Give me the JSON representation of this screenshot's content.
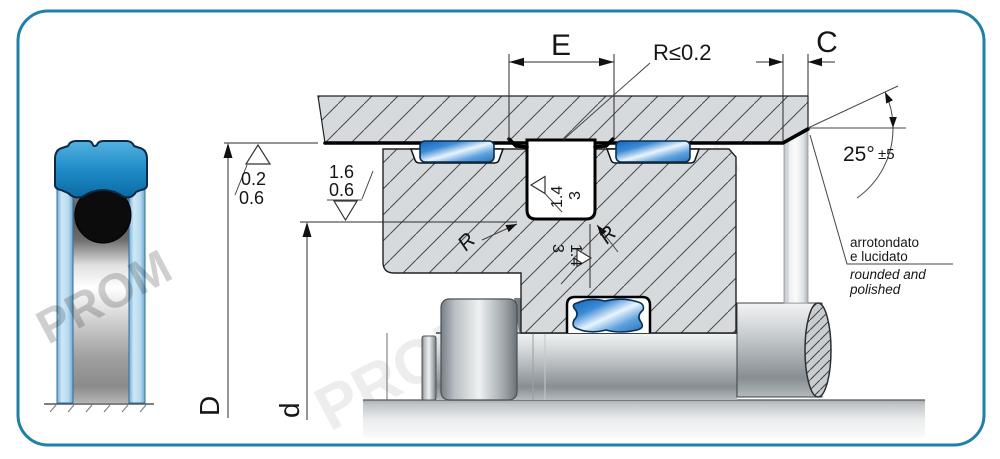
{
  "diagram": {
    "dims": {
      "e": "E",
      "c": "C",
      "d_outer": "D",
      "d_inner": "d"
    },
    "radius_note": "R≤0.2",
    "angle": {
      "value": "25°",
      "tolerance": "±5"
    },
    "roughness": {
      "bore": {
        "a": "0.2",
        "b": "0.6"
      },
      "rod": {
        "a": "1.6",
        "b": "0.6"
      },
      "groove_side": {
        "a": "1.4",
        "b": "3"
      },
      "groove_bottom": {
        "a": "3",
        "b": "1.4"
      }
    },
    "radii": {
      "left": "R",
      "right": "R"
    },
    "edge_note": {
      "it1": "arrotondato",
      "it2": "e lucidato",
      "en1": "rounded and",
      "en2": "polished"
    },
    "watermark": "PROM"
  },
  "colors": {
    "frame": "#1f81a9",
    "seal_blue": "#2f7fc4",
    "seal_highlight": "#e9f4fd",
    "cap_blue": "#1f8cc9",
    "oring_black": "#0c0c0c",
    "hatch_fill": "#d7dadc",
    "line": "#1a1a1a"
  }
}
